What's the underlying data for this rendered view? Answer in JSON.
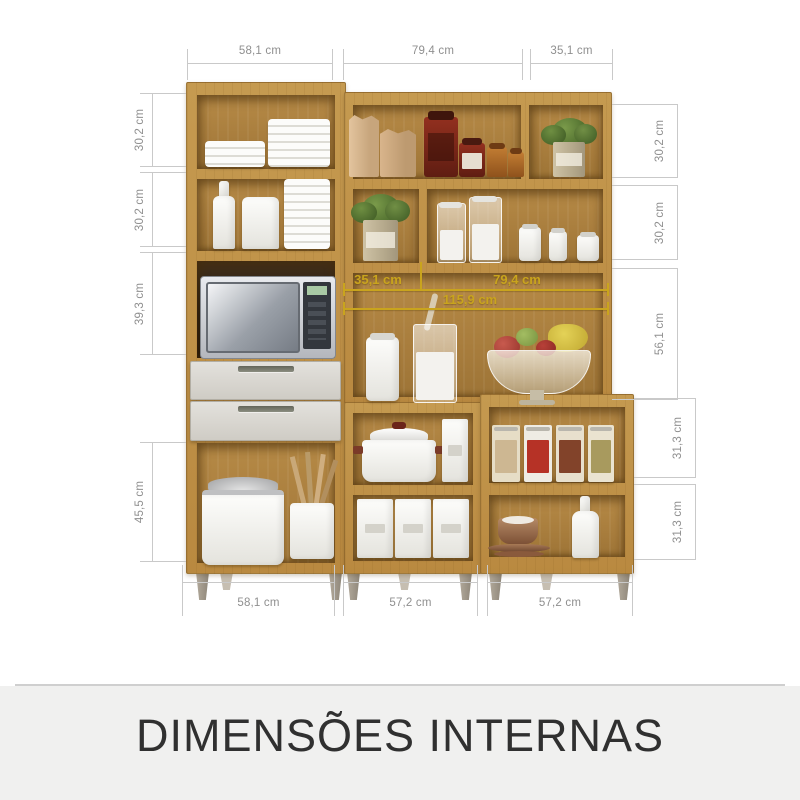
{
  "footer": {
    "title": "DIMENSÕES INTERNAS"
  },
  "colors": {
    "wood": "#bb8c42",
    "dim_line": "#c9c9c9",
    "dim_text": "#8f8f8f",
    "internal_accent": "#c9a41d",
    "drawer": "#d7d4ce",
    "footer_band": "#f0f0ef"
  },
  "dimensions": {
    "top": [
      "58,1 cm",
      "79,4 cm",
      "35,1 cm"
    ],
    "left": [
      "30,2 cm",
      "30,2 cm",
      "39,3 cm",
      "45,5 cm"
    ],
    "right": [
      "30,2 cm",
      "30,2 cm",
      "56,1 cm",
      "31,3 cm",
      "31,3 cm"
    ],
    "bottom": [
      "58,1 cm",
      "57,2 cm",
      "57,2 cm"
    ],
    "internal": {
      "left_section": "35,1 cm",
      "right_section": "79,4 cm",
      "total": "115,9 cm"
    }
  }
}
